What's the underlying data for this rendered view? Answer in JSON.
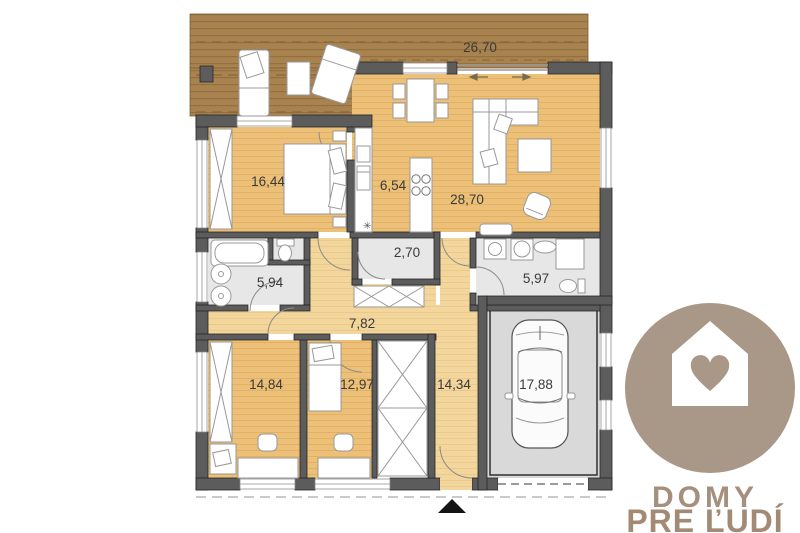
{
  "plan": {
    "title": "house-floor-plan",
    "labels": {
      "terrace": "26,70",
      "bedroom_main": "16,44",
      "kitchen": "6,54",
      "living": "28,70",
      "closet_small": "2,70",
      "bathroom": "5,94",
      "utility": "5,97",
      "hallway": "7,82",
      "bedroom_left": "14,84",
      "bedroom_mid": "12,97",
      "corridor": "14,34",
      "garage": "17,88"
    },
    "colors": {
      "deck_brown": "#a8834f",
      "floor_wood": "#ecc078",
      "floor_hall": "#f2d69c",
      "floor_tile": "#e7e7e7",
      "floor_garage": "#d9d9d9",
      "wall_gray": "#5c5c5c",
      "label_text": "#3a3a3a"
    }
  },
  "logo": {
    "line1": "DOMY",
    "line2": "PRE ĽUDÍ",
    "badge_color": "#a99787",
    "icon": "house-heart-icon"
  }
}
